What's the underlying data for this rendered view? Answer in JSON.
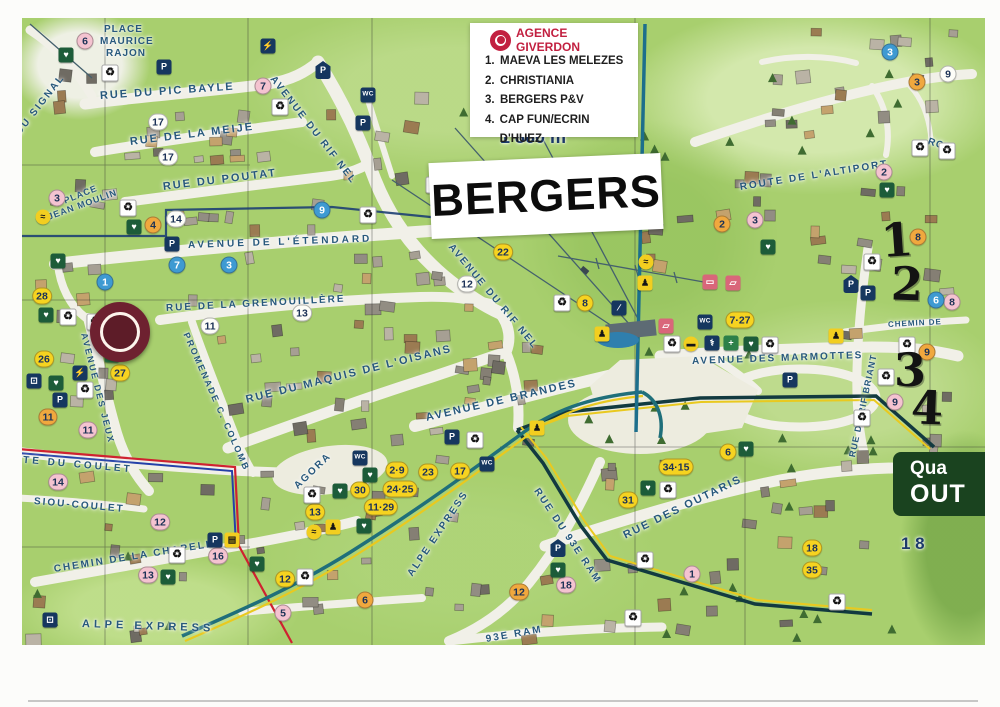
{
  "map_title": "BERGERS",
  "legend": {
    "agency": "AGENCE GIVERDON",
    "items": [
      {
        "num": "1.",
        "label": "MAEVA LES MELEZES"
      },
      {
        "num": "2.",
        "label": "CHRISTIANIA"
      },
      {
        "num": "3.",
        "label": "BERGERS P&V"
      },
      {
        "num": "4.",
        "label": "CAP FUN/ECRIN D'HUEZ"
      }
    ]
  },
  "district_sign": {
    "line1": "Qua",
    "line2": "OUT"
  },
  "altitude_labels": [
    {
      "text": "1 860 m",
      "x": 500,
      "y": 127,
      "s": 18
    },
    {
      "text": "1 8",
      "x": 901,
      "y": 534,
      "s": 17
    }
  ],
  "handwritten": [
    {
      "t": "1",
      "x": 897,
      "y": 240,
      "r": -4
    },
    {
      "t": "2",
      "x": 907,
      "y": 284,
      "r": 2
    },
    {
      "t": "3",
      "x": 910,
      "y": 370,
      "r": 0
    },
    {
      "t": "4",
      "x": 927,
      "y": 408,
      "r": 2
    }
  ],
  "streets": [
    {
      "text": "PLACE",
      "x": 104,
      "y": 24,
      "r": 0,
      "s": 10,
      "ls": 1
    },
    {
      "text": "MAURICE",
      "x": 100,
      "y": 36,
      "r": 0,
      "s": 10,
      "ls": 1
    },
    {
      "text": "RAJON",
      "x": 106,
      "y": 48,
      "r": 0,
      "s": 10,
      "ls": 1
    },
    {
      "text": "RUE DU PIC BAYLE",
      "x": 100,
      "y": 90,
      "r": -4,
      "s": 11,
      "ls": 2
    },
    {
      "text": "RUE DE LA MEIJE",
      "x": 130,
      "y": 136,
      "r": -7,
      "s": 11,
      "ls": 2
    },
    {
      "text": "DU SIGNAL",
      "x": 18,
      "y": 128,
      "r": -52,
      "s": 10,
      "ls": 2
    },
    {
      "text": "RUE DU POUTAT",
      "x": 163,
      "y": 181,
      "r": -7,
      "s": 11,
      "ls": 2
    },
    {
      "text": "PLACE",
      "x": 64,
      "y": 196,
      "r": -22,
      "s": 9,
      "ls": 1
    },
    {
      "text": "JEAN MOULIN",
      "x": 48,
      "y": 212,
      "r": -20,
      "s": 9,
      "ls": 1
    },
    {
      "text": "AVENUE DE L'ÉTENDARD",
      "x": 188,
      "y": 240,
      "r": -2,
      "s": 10,
      "ls": 3
    },
    {
      "text": "RUE DE LA GRENOUILLÈRE",
      "x": 166,
      "y": 303,
      "r": -3,
      "s": 10,
      "ls": 2
    },
    {
      "text": "PROMENADE C. COLOMB",
      "x": 186,
      "y": 328,
      "r": 66,
      "s": 9,
      "ls": 2
    },
    {
      "text": "AVENUE DES JEUX",
      "x": 84,
      "y": 328,
      "r": 76,
      "s": 9,
      "ls": 2
    },
    {
      "text": "AVENUE DU RIF NEL",
      "x": 272,
      "y": 72,
      "r": 52,
      "s": 10,
      "ls": 2
    },
    {
      "text": "AVENUE DU RIF NEL",
      "x": 450,
      "y": 240,
      "r": 50,
      "s": 10,
      "ls": 2
    },
    {
      "text": "RUE DU MAQUIS DE L'OISANS",
      "x": 246,
      "y": 394,
      "r": -14,
      "s": 11,
      "ls": 2
    },
    {
      "text": "AVENUE DE BRANDES",
      "x": 426,
      "y": 412,
      "r": -13,
      "s": 11,
      "ls": 2
    },
    {
      "text": "AVENUE DES MARMOTTES",
      "x": 692,
      "y": 356,
      "r": -2,
      "s": 10,
      "ls": 2
    },
    {
      "text": "ROUTE DE L'ALTIPORT",
      "x": 740,
      "y": 182,
      "r": -9,
      "s": 10,
      "ls": 2
    },
    {
      "text": "ROU",
      "x": 928,
      "y": 136,
      "r": 18,
      "s": 10,
      "ls": 1
    },
    {
      "text": "CHEMIN DE",
      "x": 888,
      "y": 320,
      "r": -3,
      "s": 8,
      "ls": 1
    },
    {
      "text": "RUE DU RIF BRIANT",
      "x": 852,
      "y": 452,
      "r": -78,
      "s": 9,
      "ls": 1
    },
    {
      "text": "RUE DU 93E RAM",
      "x": 536,
      "y": 484,
      "r": 56,
      "s": 10,
      "ls": 2
    },
    {
      "text": "93E RAM",
      "x": 486,
      "y": 634,
      "r": -10,
      "s": 10,
      "ls": 2
    },
    {
      "text": "RUE DES OUTARIS",
      "x": 624,
      "y": 530,
      "r": -26,
      "s": 11,
      "ls": 2
    },
    {
      "text": "ROUTE DU COULET",
      "x": -8,
      "y": 452,
      "r": 5,
      "s": 10,
      "ls": 3
    },
    {
      "text": "SIOU-COULET",
      "x": 34,
      "y": 496,
      "r": 5,
      "s": 10,
      "ls": 2
    },
    {
      "text": "CHEMIN DE LA CHAPELLE",
      "x": 54,
      "y": 564,
      "r": -9,
      "s": 10,
      "ls": 2
    },
    {
      "text": "ALPE EXPRESS",
      "x": 82,
      "y": 618,
      "r": 2,
      "s": 11,
      "ls": 4
    },
    {
      "text": "ALPE EXPRESS",
      "x": 410,
      "y": 570,
      "r": -56,
      "s": 10,
      "ls": 2
    },
    {
      "text": "AGORA",
      "x": 296,
      "y": 482,
      "r": -44,
      "s": 10,
      "ls": 2
    }
  ],
  "badges": [
    {
      "t": "6",
      "c": "pink",
      "x": 85,
      "y": 41
    },
    {
      "t": "7",
      "c": "pink",
      "x": 263,
      "y": 86
    },
    {
      "t": "3",
      "c": "pink",
      "x": 57,
      "y": 198
    },
    {
      "t": "2",
      "c": "pink",
      "x": 884,
      "y": 172
    },
    {
      "t": "3",
      "c": "pink",
      "x": 755,
      "y": 220
    },
    {
      "t": "11",
      "c": "pink",
      "x": 88,
      "y": 430
    },
    {
      "t": "14",
      "c": "pink",
      "x": 58,
      "y": 482
    },
    {
      "t": "12",
      "c": "pink",
      "x": 160,
      "y": 522
    },
    {
      "t": "16",
      "c": "pink",
      "x": 218,
      "y": 556
    },
    {
      "t": "13",
      "c": "pink",
      "x": 148,
      "y": 575
    },
    {
      "t": "5",
      "c": "pink",
      "x": 283,
      "y": 613
    },
    {
      "t": "1",
      "c": "pink",
      "x": 692,
      "y": 574
    },
    {
      "t": "18",
      "c": "pink",
      "x": 566,
      "y": 585
    },
    {
      "t": "9",
      "c": "pink",
      "x": 895,
      "y": 402
    },
    {
      "t": "8",
      "c": "pink",
      "x": 952,
      "y": 302
    },
    {
      "t": "4",
      "c": "orange",
      "x": 153,
      "y": 225
    },
    {
      "t": "2",
      "c": "orange",
      "x": 722,
      "y": 224
    },
    {
      "t": "3",
      "c": "orange",
      "x": 917,
      "y": 82
    },
    {
      "t": "8",
      "c": "orange",
      "x": 918,
      "y": 237
    },
    {
      "t": "9",
      "c": "orange",
      "x": 927,
      "y": 352
    },
    {
      "t": "11",
      "c": "orange",
      "x": 48,
      "y": 417
    },
    {
      "t": "6",
      "c": "orange",
      "x": 365,
      "y": 600
    },
    {
      "t": "12",
      "c": "orange",
      "x": 519,
      "y": 592
    },
    {
      "t": "28",
      "c": "yellow",
      "x": 42,
      "y": 296
    },
    {
      "t": "26",
      "c": "yellow",
      "x": 44,
      "y": 359
    },
    {
      "t": "27",
      "c": "yellow",
      "x": 120,
      "y": 373
    },
    {
      "t": "8",
      "c": "yellow",
      "x": 585,
      "y": 303
    },
    {
      "t": "22",
      "c": "yellow",
      "x": 503,
      "y": 252
    },
    {
      "t": "13",
      "c": "yellow",
      "x": 315,
      "y": 512
    },
    {
      "t": "12",
      "c": "yellow",
      "x": 285,
      "y": 579
    },
    {
      "t": "6",
      "c": "yellow",
      "x": 728,
      "y": 452
    },
    {
      "t": "31",
      "c": "yellow",
      "x": 628,
      "y": 500
    },
    {
      "t": "18",
      "c": "yellow",
      "x": 812,
      "y": 548
    },
    {
      "t": "35",
      "c": "yellow",
      "x": 812,
      "y": 570
    },
    {
      "t": "34·15",
      "c": "yellow",
      "x": 676,
      "y": 467
    },
    {
      "t": "7·27",
      "c": "yellow",
      "x": 740,
      "y": 320
    },
    {
      "t": "2·9",
      "c": "yellow",
      "x": 397,
      "y": 470
    },
    {
      "t": "23",
      "c": "yellow",
      "x": 428,
      "y": 472
    },
    {
      "t": "24·25",
      "c": "yellow",
      "x": 400,
      "y": 489
    },
    {
      "t": "30",
      "c": "yellow",
      "x": 360,
      "y": 490
    },
    {
      "t": "11·29",
      "c": "yellow",
      "x": 381,
      "y": 507
    },
    {
      "t": "17",
      "c": "yellow",
      "x": 460,
      "y": 471
    },
    {
      "t": "1",
      "c": "blue",
      "x": 105,
      "y": 282
    },
    {
      "t": "7",
      "c": "blue",
      "x": 177,
      "y": 265
    },
    {
      "t": "3",
      "c": "blue",
      "x": 229,
      "y": 265
    },
    {
      "t": "9",
      "c": "blue",
      "x": 322,
      "y": 210
    },
    {
      "t": "3",
      "c": "blue",
      "x": 890,
      "y": 52
    },
    {
      "t": "6",
      "c": "blue",
      "x": 936,
      "y": 300
    },
    {
      "t": "17",
      "c": "white",
      "x": 158,
      "y": 122
    },
    {
      "t": "17",
      "c": "white",
      "x": 168,
      "y": 157
    },
    {
      "t": "14",
      "c": "white",
      "x": 176,
      "y": 219
    },
    {
      "t": "12",
      "c": "white",
      "x": 467,
      "y": 284
    },
    {
      "t": "13",
      "c": "white",
      "x": 302,
      "y": 313
    },
    {
      "t": "11",
      "c": "white",
      "x": 210,
      "y": 326
    },
    {
      "t": "9",
      "c": "white",
      "x": 948,
      "y": 74
    }
  ],
  "icon_glyphs": {
    "parking": "P",
    "shelter": "P",
    "wc": "WC",
    "recycle": "♻",
    "heart": "♥",
    "medic": "+",
    "doctor": "⚕",
    "plug": "⚡",
    "gondola": "⊡",
    "escalator": "∕",
    "bar": "▭",
    "ticket": "▱",
    "ski": "♟",
    "trail": "≈",
    "basket": "▤",
    "shuttle": "▬"
  },
  "icons": [
    {
      "t": "parking",
      "x": 164,
      "y": 67
    },
    {
      "t": "parking",
      "x": 363,
      "y": 123
    },
    {
      "t": "parking",
      "x": 172,
      "y": 244
    },
    {
      "t": "parking",
      "x": 60,
      "y": 400
    },
    {
      "t": "parking",
      "x": 452,
      "y": 437
    },
    {
      "t": "parking",
      "x": 790,
      "y": 380
    },
    {
      "t": "parking",
      "x": 868,
      "y": 293
    },
    {
      "t": "parking",
      "x": 215,
      "y": 540
    },
    {
      "t": "shelter",
      "x": 323,
      "y": 70
    },
    {
      "t": "shelter",
      "x": 558,
      "y": 548
    },
    {
      "t": "shelter",
      "x": 851,
      "y": 284
    },
    {
      "t": "wc",
      "x": 368,
      "y": 95
    },
    {
      "t": "wc",
      "x": 705,
      "y": 322
    },
    {
      "t": "wc",
      "x": 360,
      "y": 458
    },
    {
      "t": "wc",
      "x": 487,
      "y": 464
    },
    {
      "t": "recycle",
      "x": 110,
      "y": 73
    },
    {
      "t": "recycle",
      "x": 280,
      "y": 107
    },
    {
      "t": "recycle",
      "x": 128,
      "y": 208
    },
    {
      "t": "recycle",
      "x": 68,
      "y": 317
    },
    {
      "t": "recycle",
      "x": 95,
      "y": 322
    },
    {
      "t": "recycle",
      "x": 85,
      "y": 390
    },
    {
      "t": "recycle",
      "x": 434,
      "y": 185
    },
    {
      "t": "recycle",
      "x": 368,
      "y": 215
    },
    {
      "t": "recycle",
      "x": 562,
      "y": 303
    },
    {
      "t": "recycle",
      "x": 672,
      "y": 344
    },
    {
      "t": "recycle",
      "x": 770,
      "y": 345
    },
    {
      "t": "recycle",
      "x": 872,
      "y": 262
    },
    {
      "t": "recycle",
      "x": 920,
      "y": 148
    },
    {
      "t": "recycle",
      "x": 947,
      "y": 151
    },
    {
      "t": "recycle",
      "x": 907,
      "y": 345
    },
    {
      "t": "recycle",
      "x": 886,
      "y": 377
    },
    {
      "t": "recycle",
      "x": 862,
      "y": 418
    },
    {
      "t": "recycle",
      "x": 668,
      "y": 490
    },
    {
      "t": "recycle",
      "x": 645,
      "y": 560
    },
    {
      "t": "recycle",
      "x": 837,
      "y": 602
    },
    {
      "t": "recycle",
      "x": 633,
      "y": 618
    },
    {
      "t": "recycle",
      "x": 177,
      "y": 555
    },
    {
      "t": "recycle",
      "x": 312,
      "y": 495
    },
    {
      "t": "recycle",
      "x": 475,
      "y": 440
    },
    {
      "t": "recycle",
      "x": 305,
      "y": 577
    },
    {
      "t": "heart",
      "x": 66,
      "y": 55
    },
    {
      "t": "heart",
      "x": 134,
      "y": 227
    },
    {
      "t": "heart",
      "x": 58,
      "y": 261
    },
    {
      "t": "heart",
      "x": 46,
      "y": 315
    },
    {
      "t": "heart",
      "x": 56,
      "y": 383
    },
    {
      "t": "heart",
      "x": 768,
      "y": 247
    },
    {
      "t": "heart",
      "x": 751,
      "y": 344
    },
    {
      "t": "heart",
      "x": 887,
      "y": 190
    },
    {
      "t": "heart",
      "x": 746,
      "y": 449
    },
    {
      "t": "heart",
      "x": 648,
      "y": 488
    },
    {
      "t": "heart",
      "x": 558,
      "y": 570
    },
    {
      "t": "heart",
      "x": 168,
      "y": 577
    },
    {
      "t": "heart",
      "x": 257,
      "y": 564
    },
    {
      "t": "heart",
      "x": 370,
      "y": 475
    },
    {
      "t": "heart",
      "x": 340,
      "y": 491
    },
    {
      "t": "heart",
      "x": 364,
      "y": 526
    },
    {
      "t": "medic",
      "x": 112,
      "y": 355
    },
    {
      "t": "medic",
      "x": 731,
      "y": 343
    },
    {
      "t": "doctor",
      "x": 712,
      "y": 343
    },
    {
      "t": "plug",
      "x": 268,
      "y": 46
    },
    {
      "t": "plug",
      "x": 80,
      "y": 373
    },
    {
      "t": "gondola",
      "x": 34,
      "y": 381
    },
    {
      "t": "gondola",
      "x": 50,
      "y": 620
    },
    {
      "t": "escalator",
      "x": 619,
      "y": 308
    },
    {
      "t": "bar",
      "x": 710,
      "y": 282
    },
    {
      "t": "ticket",
      "x": 733,
      "y": 283
    },
    {
      "t": "ticket",
      "x": 666,
      "y": 326
    },
    {
      "t": "ski",
      "x": 537,
      "y": 428
    },
    {
      "t": "ski",
      "x": 333,
      "y": 527
    },
    {
      "t": "ski",
      "x": 602,
      "y": 334
    },
    {
      "t": "ski",
      "x": 836,
      "y": 336
    },
    {
      "t": "ski",
      "x": 645,
      "y": 283
    },
    {
      "t": "trail",
      "x": 43,
      "y": 217
    },
    {
      "t": "trail",
      "x": 314,
      "y": 532
    },
    {
      "t": "trail",
      "x": 646,
      "y": 262
    },
    {
      "t": "basket",
      "x": 232,
      "y": 540
    },
    {
      "t": "shuttle",
      "x": 691,
      "y": 344
    }
  ],
  "colors": {
    "agency_red": "#c22040",
    "street_blue": "#27587c",
    "sign_green": "#1a431f",
    "handwriting": "#131313",
    "altitude_blue": "#1d3a6b",
    "badge_pink": "#f4c3d0",
    "badge_orange": "#f0a83e",
    "badge_yellow": "#f6d320",
    "badge_blue": "#3e9ad2",
    "badge_white": "#fdfdf8",
    "icon_navy": "#16375f",
    "icon_green": "#1d5c39",
    "icon_medic": "#2c8049",
    "icon_pink": "#d9667a",
    "icon_yellow": "#f2ce20"
  }
}
